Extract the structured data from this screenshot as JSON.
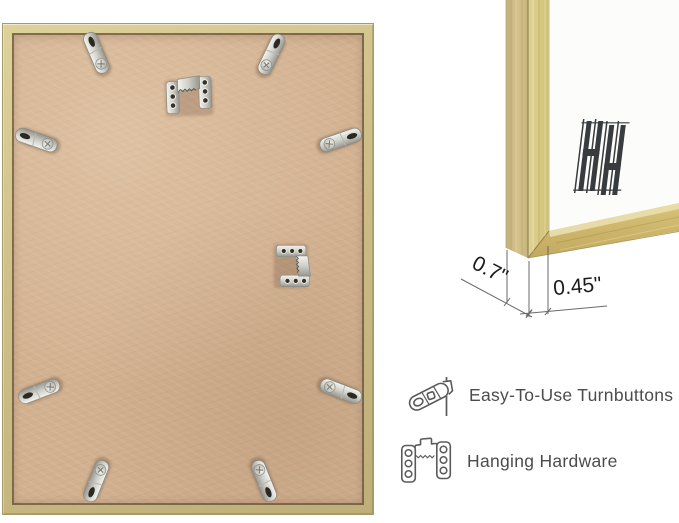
{
  "image_type": "product-listing-image",
  "back_view": {
    "hardware_counts": {
      "turnbuttons": 8,
      "sawtooth_hangers": 2
    },
    "frame_color": "#cdbf86",
    "backing_color": "#d2b190"
  },
  "corner_detail": {
    "depth_label": "0.7\"",
    "face_width_label": "0.45\"",
    "brand_logo": "HH monogram",
    "wood_side_color": "#cfbd8a",
    "wood_front_color": "#d9cb86",
    "wood_bottom_color": "#cdb76e"
  },
  "features": [
    {
      "icon": "turnbutton-icon",
      "label": "Easy-To-Use Turnbuttons"
    },
    {
      "icon": "hanging-hardware-icon",
      "label": "Hanging Hardware"
    }
  ],
  "colors": {
    "dimension_text": "#1b1b1b",
    "feature_text": "#4c4c4c",
    "outline_gray": "#5a5a5a",
    "background": "#ffffff"
  }
}
